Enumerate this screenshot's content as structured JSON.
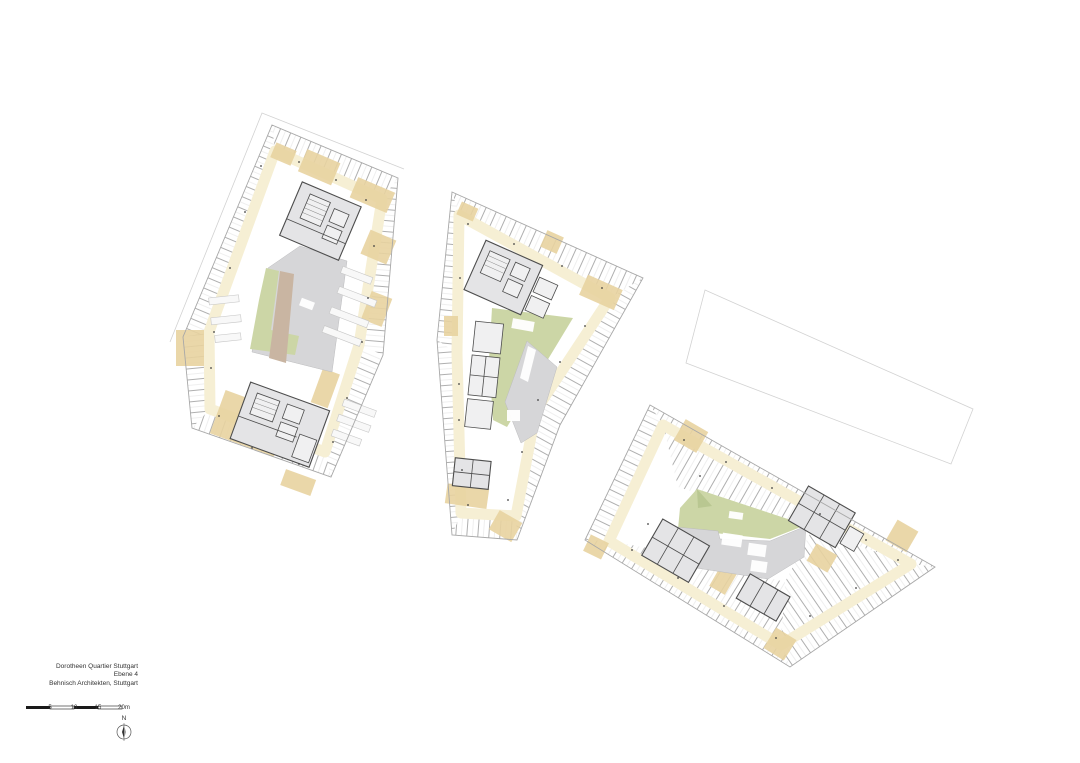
{
  "title_block": {
    "project": "Dorotheen Quartier Stuttgart",
    "level": "Ebene 4",
    "architect": "Behnisch Architekten, Stuttgart"
  },
  "scale_bar": {
    "tick_labels": [
      "5",
      "10",
      "15",
      "20m"
    ]
  },
  "north_arrow": {
    "label": "N"
  },
  "colors": {
    "corridor": "#f6efd4",
    "corridor_accent": "#e8d3a0",
    "courtyard_gray": "#d6d6d8",
    "core_gray": "#e4e4e6",
    "wall_dark": "#4d4d4d",
    "partition": "#9b9b9b",
    "outline": "#a8a8a8",
    "faint_outline": "#d2d2d2",
    "green": "#ccd6a6",
    "green_dark": "#b9c791",
    "tan": "#c9b5a2",
    "scale_black": "#1a1a1a",
    "text": "#333333"
  }
}
